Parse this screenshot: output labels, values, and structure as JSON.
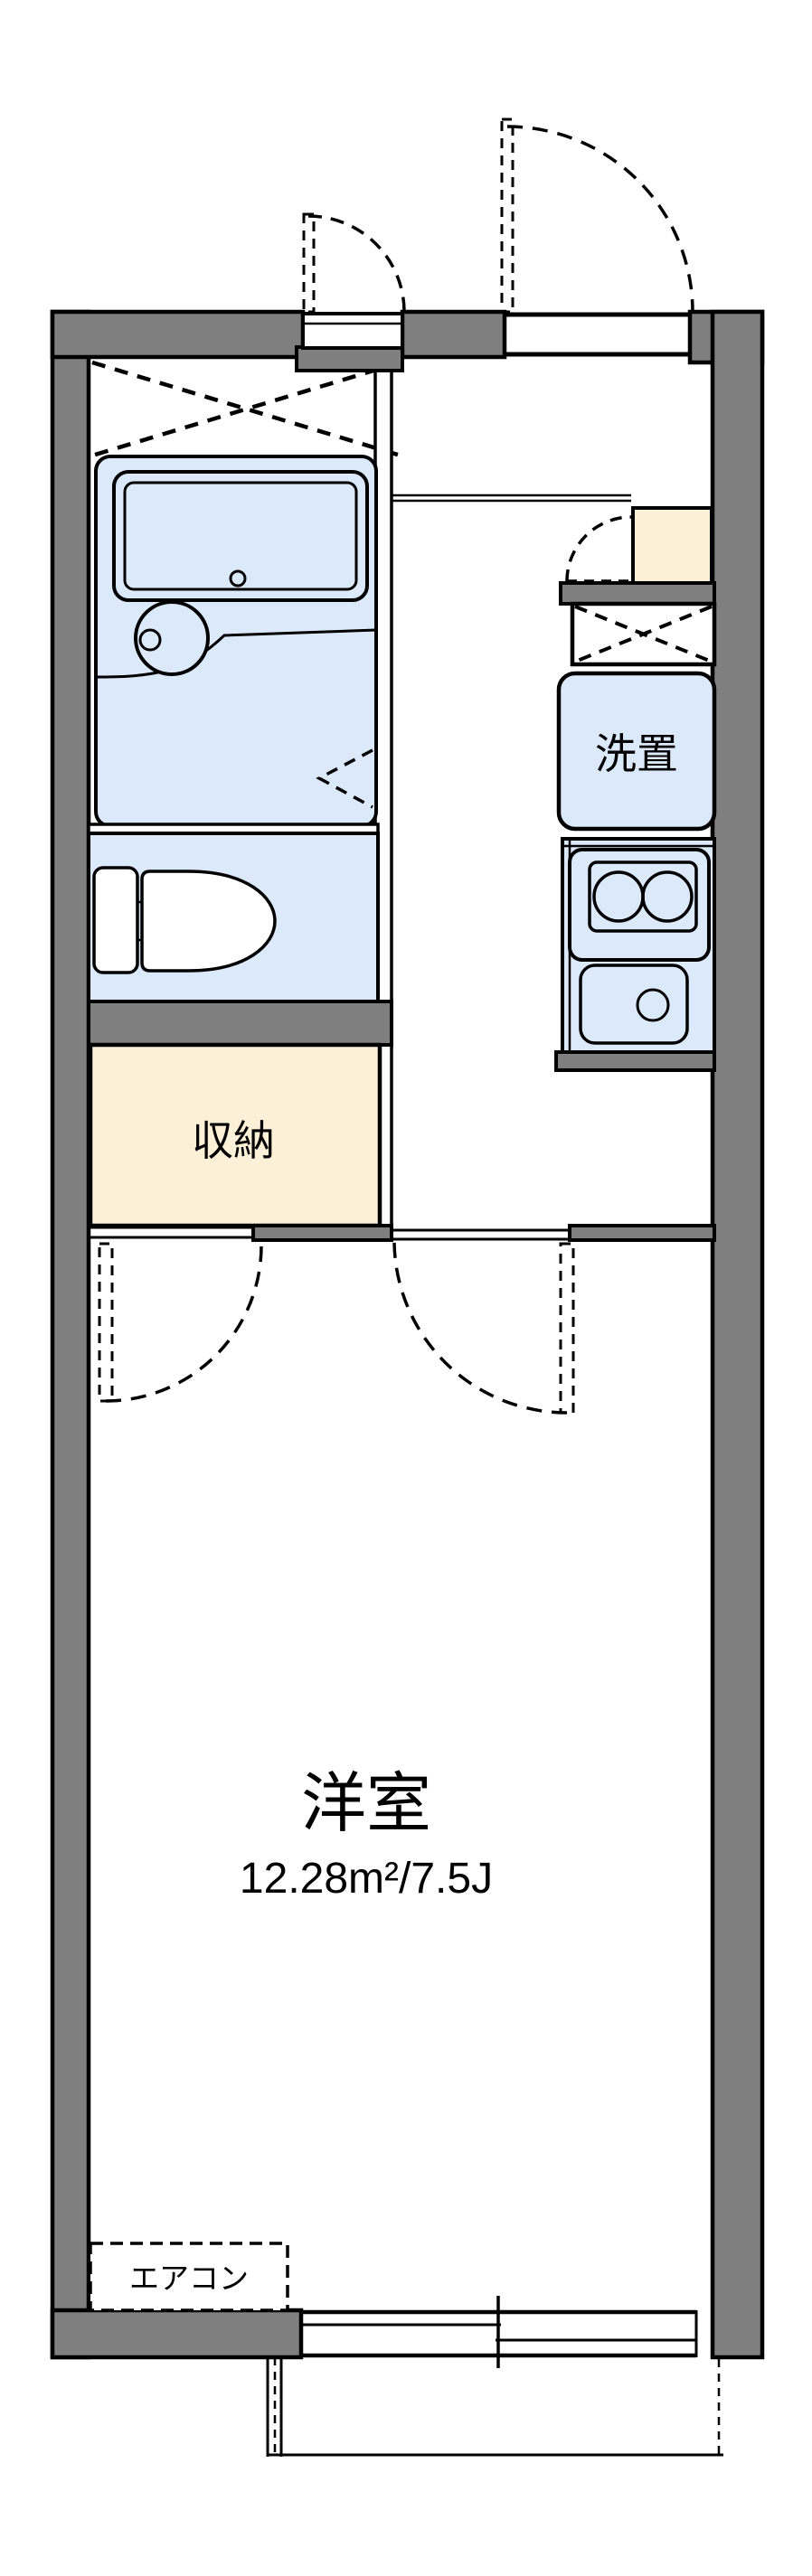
{
  "floorplan": {
    "labels": {
      "laundry": "洗置",
      "storage": "収納",
      "room_name": "洋室",
      "room_area": "12.28m²/7.5J",
      "aircon": "エアコン"
    },
    "room": {
      "area_m2": "12.28",
      "tatami": "7.5J"
    },
    "colors": {
      "wall_gray": "#7f7f7f",
      "fixture_blue": "#dce9fb",
      "storage_cream": "#fcf0d9",
      "line_black": "#000000",
      "background": "#ffffff"
    }
  }
}
